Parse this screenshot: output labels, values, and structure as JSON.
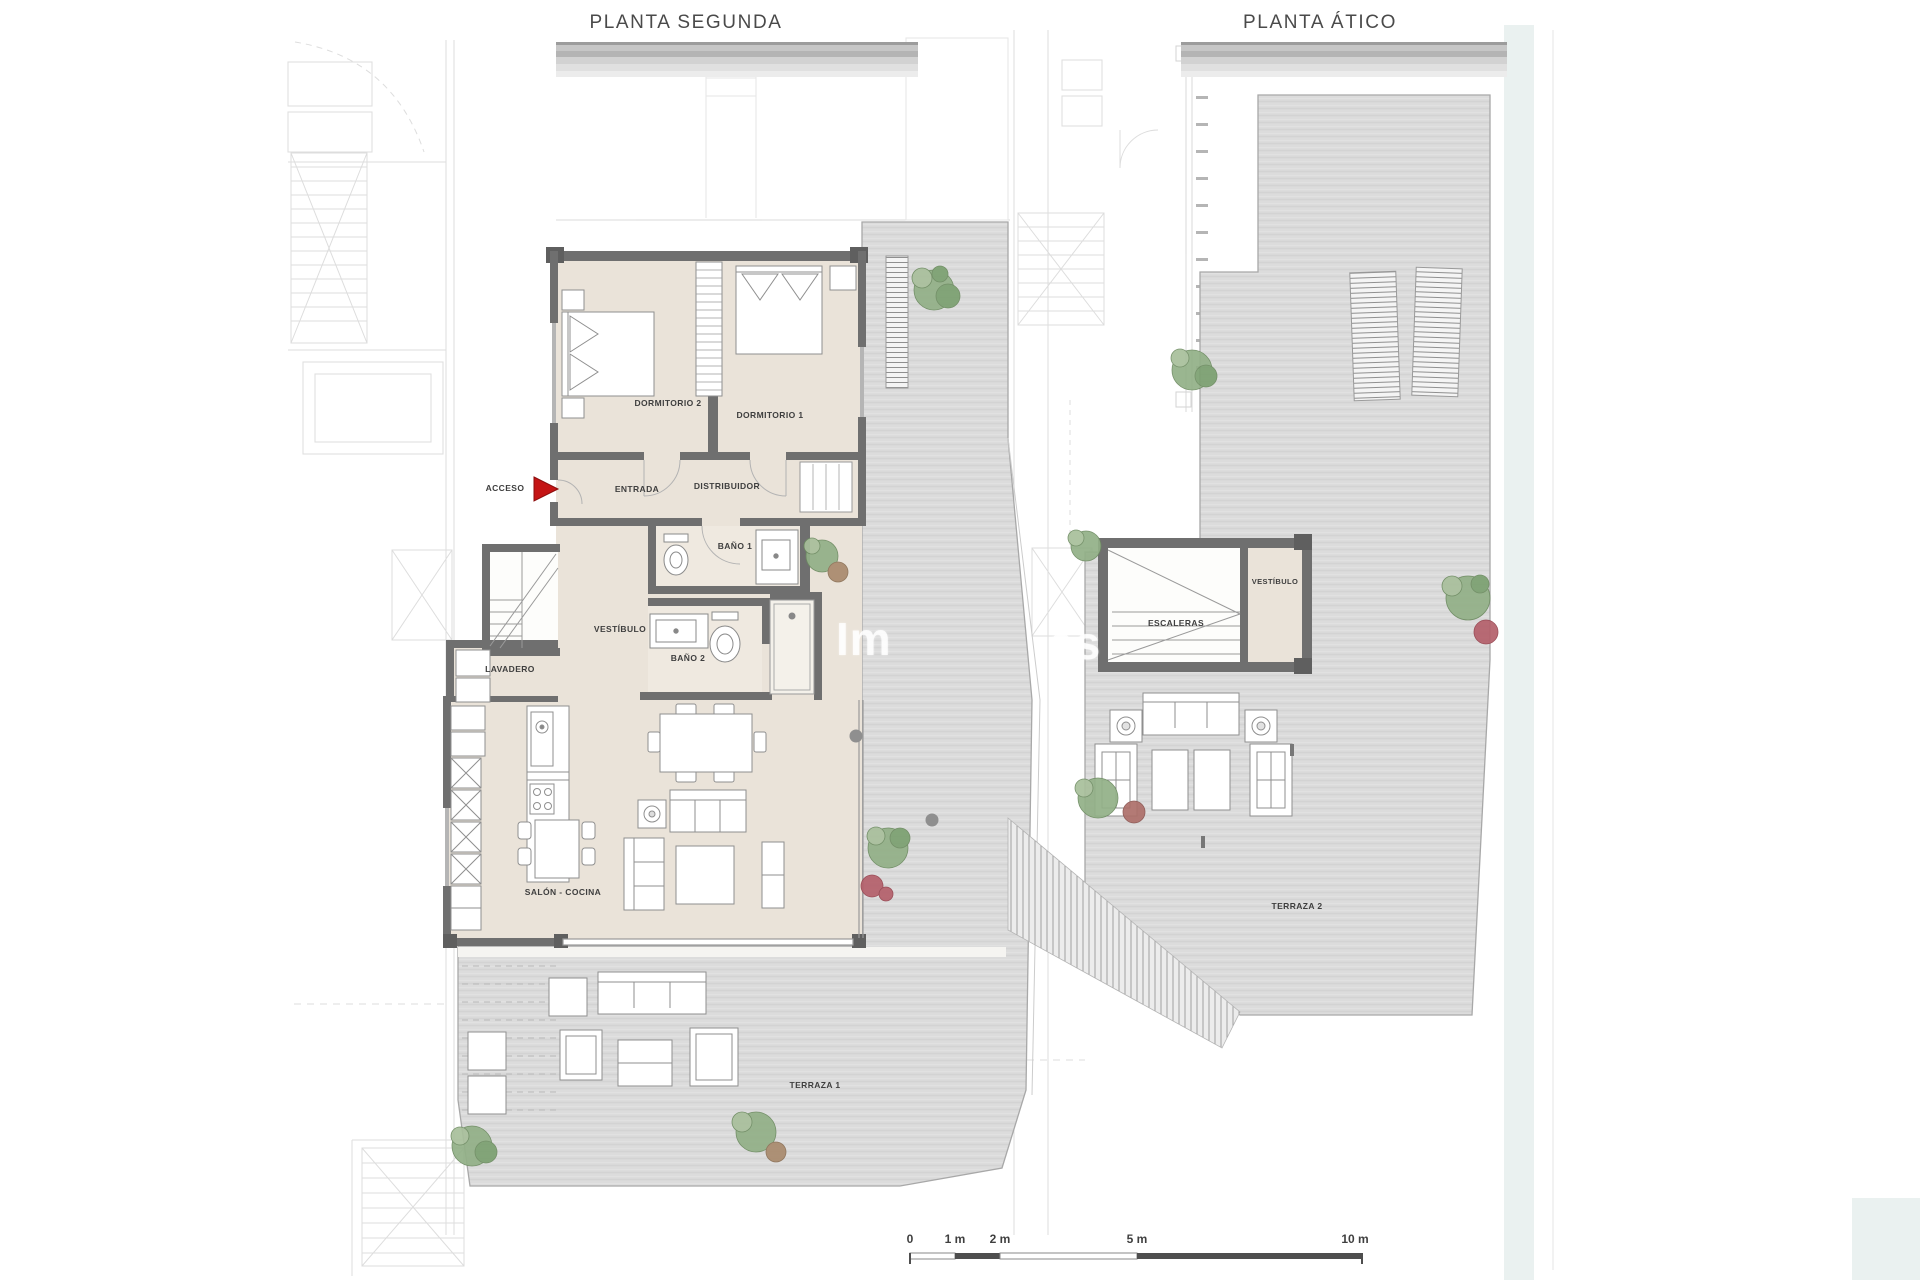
{
  "left_plan": {
    "title": "PLANTA SEGUNDA",
    "labels": {
      "acceso": "ACCESO",
      "entrada": "ENTRADA",
      "distribuidor": "DISTRIBUIDOR",
      "dormitorio2": "DORMITORIO 2",
      "dormitorio1": "DORMITORIO 1",
      "bano1": "BAÑO 1",
      "vestibulo": "VESTÍBULO",
      "bano2": "BAÑO 2",
      "lavadero": "LAVADERO",
      "salon_cocina": "SALÓN - COCINA",
      "terraza1": "TERRAZA 1"
    }
  },
  "right_plan": {
    "title": "PLANTA ÁTICO",
    "labels": {
      "escaleras": "ESCALERAS",
      "vestibulo": "VESTÍBULO",
      "terraza2": "TERRAZA 2"
    }
  },
  "scale_bar": {
    "ticks": [
      "0",
      "1 m",
      "2 m",
      "5 m",
      "10 m"
    ]
  },
  "watermark": {
    "left": "Im",
    "right": "es"
  },
  "colors": {
    "wall": "#6f6f6f",
    "interior_beige": "#eae3d9",
    "bath_beige": "#efe9e0",
    "terrace_gray": "#dcdcdc",
    "accent_red": "#c41414",
    "plant_green": "#8aa97f",
    "plant_red": "#b4606b",
    "plant_brown": "#a98a6d",
    "teal_strip": "#eaf1f0",
    "faint_line": "#c2c2c2"
  }
}
